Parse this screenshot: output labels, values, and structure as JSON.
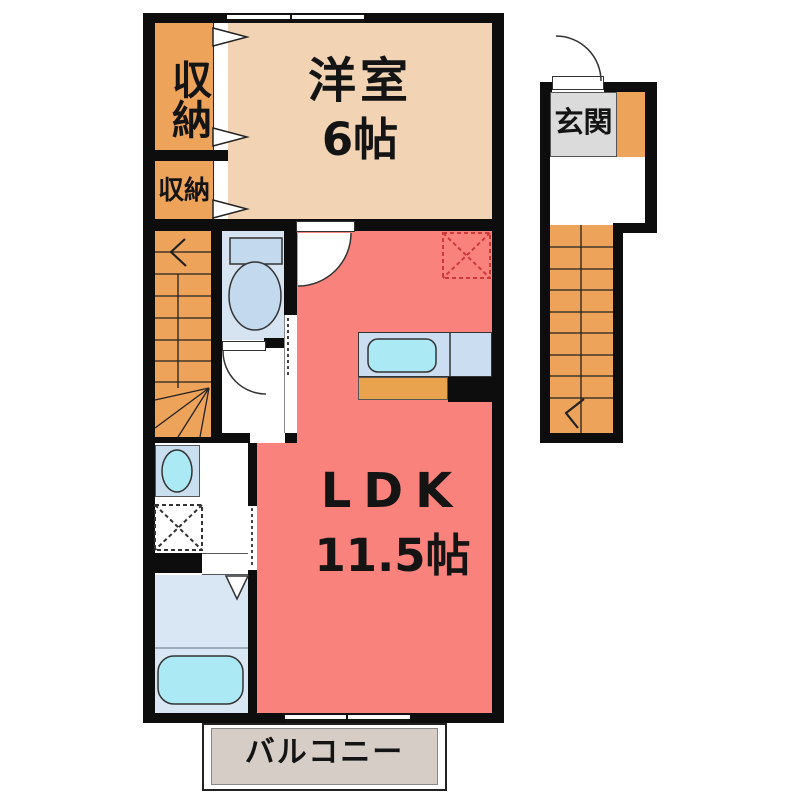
{
  "plan": {
    "rooms": {
      "western_room": {
        "label": "洋室",
        "size": "6帖"
      },
      "ldk": {
        "label": "LDK",
        "size": "11.5帖"
      },
      "entrance": {
        "label": "玄関"
      },
      "closet_upper": {
        "label": "収納"
      },
      "closet_lower": {
        "label": "収納"
      },
      "balcony": {
        "label": "バルコニー"
      }
    },
    "colors": {
      "wall": "#0d0d0d",
      "ldk": "#F9827C",
      "western_room": "#F2D3B3",
      "storage_stairs": "#EDA35A",
      "wet_room": "#D6E4F2",
      "fixture_blue": "#C3D9EE",
      "fixture_cyan": "#ABE9F4",
      "entrance_floor": "#DBDBDB",
      "balcony": "#D6CEC6",
      "fridge_marker": "#CC3A3A"
    }
  }
}
